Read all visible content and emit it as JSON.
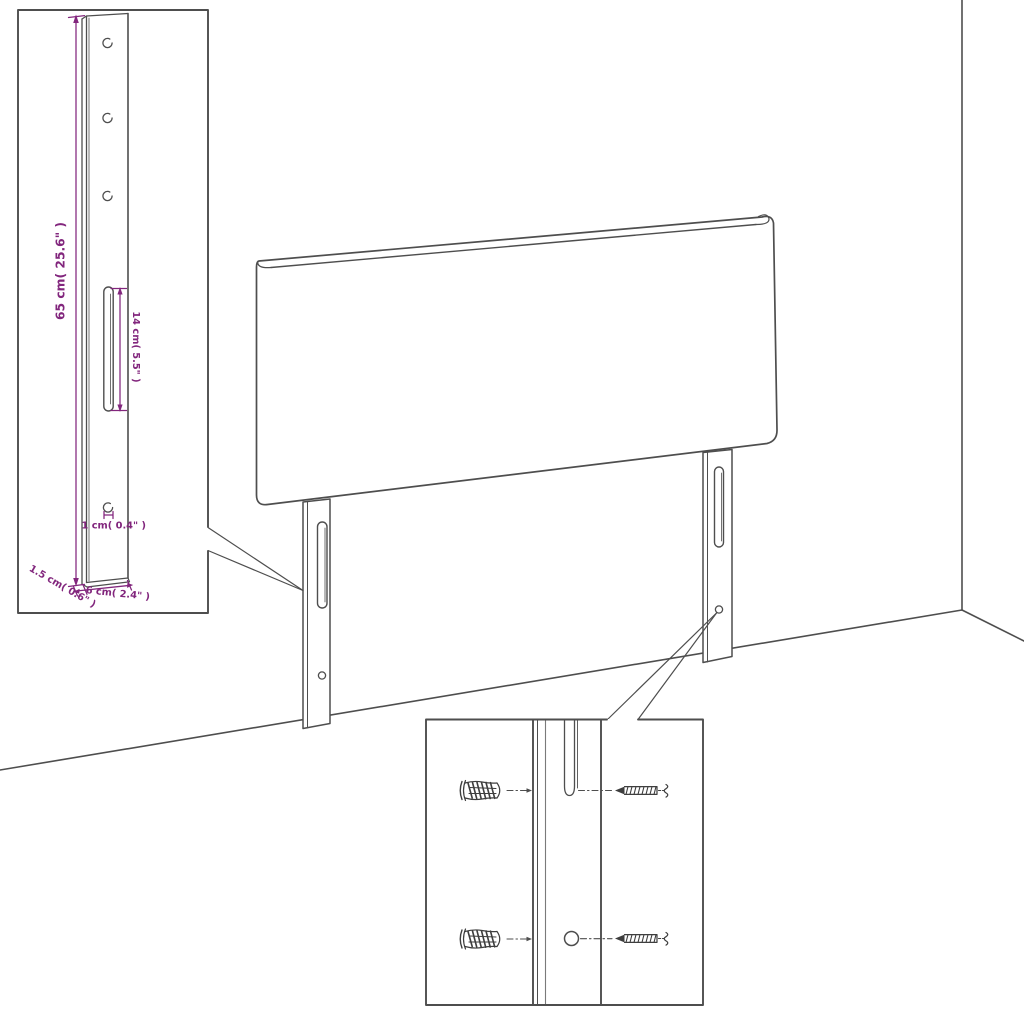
{
  "diagram": {
    "type": "headboard-assembly-dimension-diagram",
    "colors": {
      "line": "#4e4e4e",
      "dimension": "#82267d",
      "scribble": "#3e3e3e",
      "background": "#ffffff"
    },
    "bracket_detail": {
      "height_label": "65 cm( 25.6\" )",
      "slot_label": "14 cm( 5.5\" )",
      "hole_label": "1 cm( 0.4\" )",
      "depth_label": "1.5 cm( 0.6\" )",
      "width_label": "6 cm( 2.4\" )"
    },
    "icons": {
      "wall_plug": "wall-plug-icon",
      "screw": "screw-icon"
    }
  }
}
